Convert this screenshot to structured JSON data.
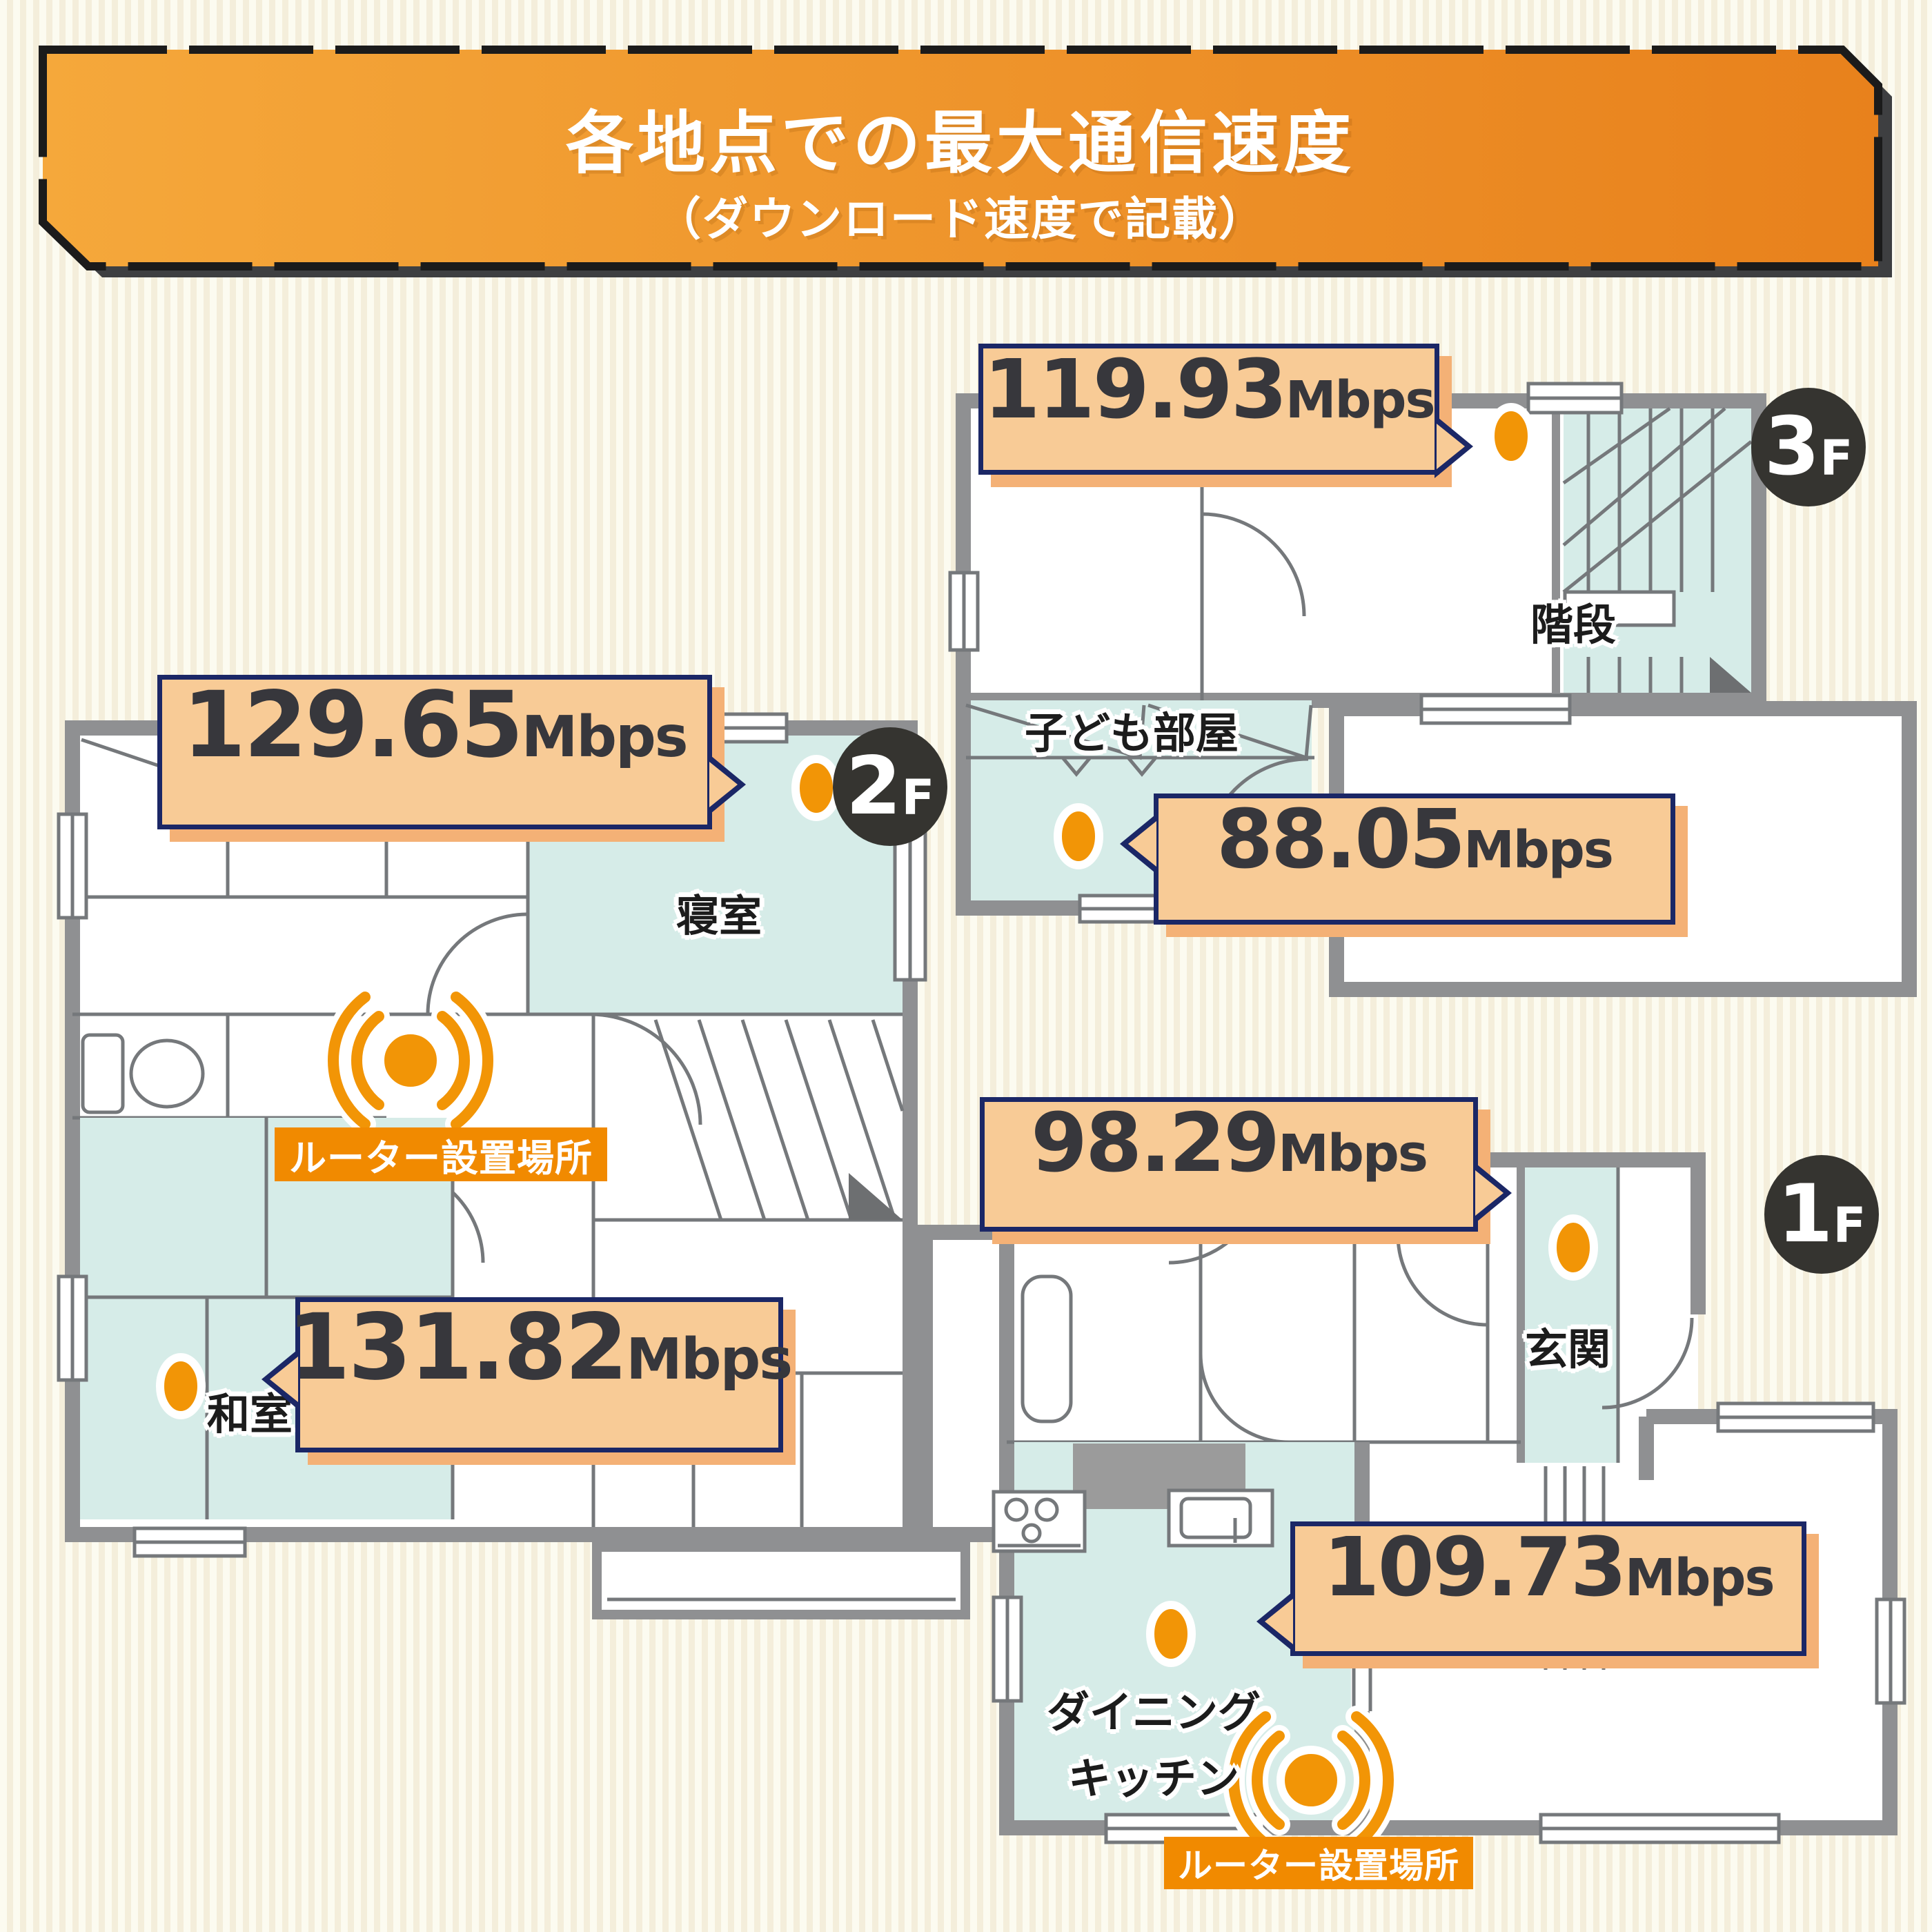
{
  "header": {
    "title": "各地点での最大通信速度",
    "subtitle": "（ダウンロード速度で記載）"
  },
  "floors": {
    "f3": {
      "badge": {
        "num": "3",
        "suffix": "F"
      },
      "rooms": {
        "stairs": "階段",
        "kids_room": "子ども部屋"
      },
      "measurements": {
        "stairs": {
          "value": "119.93",
          "unit": "Mbps"
        },
        "kids_room": {
          "value": "88.05",
          "unit": "Mbps"
        }
      }
    },
    "f2": {
      "badge": {
        "num": "2",
        "suffix": "F"
      },
      "rooms": {
        "bedroom": "寝室",
        "washitsu": "和室"
      },
      "router_label": "ルーター設置場所",
      "measurements": {
        "bedroom": {
          "value": "129.65",
          "unit": "Mbps"
        },
        "washitsu": {
          "value": "131.82",
          "unit": "Mbps"
        }
      }
    },
    "f1": {
      "badge": {
        "num": "1",
        "suffix": "F"
      },
      "rooms": {
        "genkan": "玄関",
        "dining_line1": "ダイニング",
        "dining_line2": "キッチン"
      },
      "router_label": "ルーター設置場所",
      "measurements": {
        "genkan": {
          "value": "98.29",
          "unit": "Mbps"
        },
        "dining": {
          "value": "109.73",
          "unit": "Mbps"
        }
      }
    }
  },
  "colors": {
    "accent_orange": "#F29506",
    "router_label_bg": "#F18A00",
    "bubble_fill": "#F8CB96",
    "bubble_border": "#1B2766",
    "bubble_shadow": "#F4B176",
    "room_teal": "#D6ECE8",
    "wall_gray": "#8F9092",
    "badge_bg": "#353430",
    "banner_gradient_left": "#F5A83B",
    "banner_gradient_right": "#E8811C",
    "background_stripe_light": "#FCFBF0",
    "background_stripe_dark": "#F4EEDB"
  }
}
